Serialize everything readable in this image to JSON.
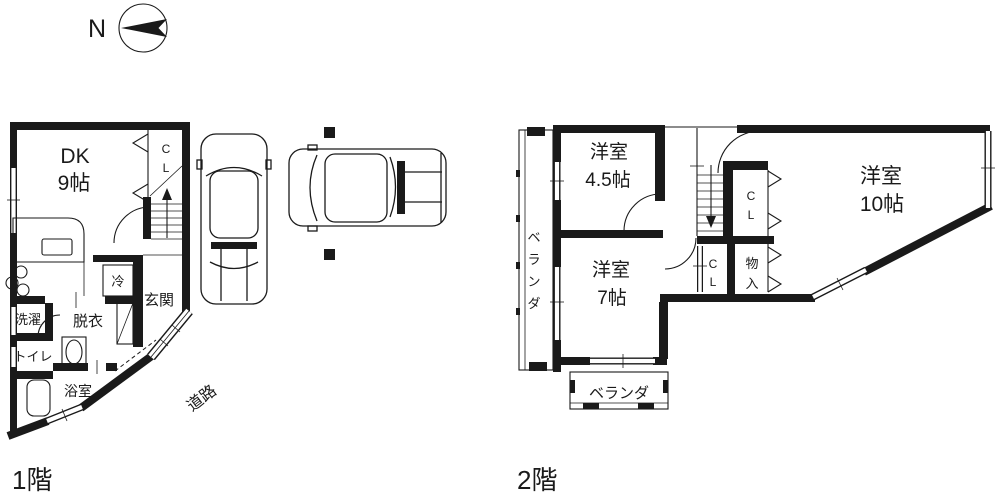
{
  "compass": {
    "north": "N"
  },
  "floor1": {
    "label": "1階",
    "dk_line1": "DK",
    "dk_line2": "9帖",
    "closet_chars": [
      "C",
      "L"
    ],
    "fridge": "冷",
    "entrance": "玄関",
    "dressing": "脱衣",
    "laundry": "洗濯",
    "toilet": "トイレ",
    "bath": "浴室",
    "road": "道路"
  },
  "floor2": {
    "label": "2階",
    "room45_line1": "洋室",
    "room45_line2": "4.5帖",
    "room10_line1": "洋室",
    "room10_line2": "10帖",
    "room7_line1": "洋室",
    "room7_line2": "7帖",
    "closet_upper_chars": [
      "C",
      "L"
    ],
    "closet_lower_chars": [
      "C",
      "L"
    ],
    "storage_chars": [
      "物",
      "入"
    ],
    "veranda_left_chars": [
      "ベ",
      "ラ",
      "ン",
      "ダ"
    ],
    "veranda_bottom": "ベランダ"
  },
  "colors": {
    "wall": "#1a1a1a",
    "background": "#ffffff"
  }
}
